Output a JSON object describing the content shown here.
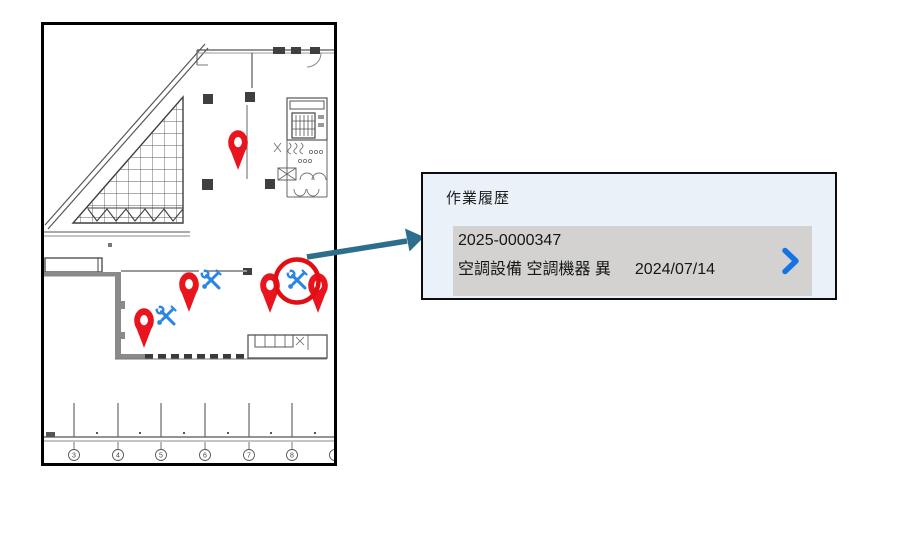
{
  "popup": {
    "title": "作業履歴",
    "item": {
      "id": "2025-0000347",
      "category": "空調設備 空調機器 異",
      "date": "2024/07/14"
    }
  },
  "floorplan": {
    "column_labels": [
      "3",
      "4",
      "5",
      "6",
      "7",
      "8"
    ]
  },
  "markers": {
    "pin_count": 5,
    "tool_icon_count": 3
  },
  "icons": {
    "pin": "map-pin",
    "tools": "wrench-and-screwdriver",
    "chevron": "chevron-right",
    "highlight": "red-circle-annotation",
    "arrow": "callout-arrow"
  },
  "colors": {
    "pin_red": "#e9141d",
    "tool_blue": "#2b85e2",
    "arrow_teal": "#2d6e8c",
    "chevron_blue": "#1474e4",
    "highlight_red": "#e10f14",
    "popup_bg": "#eaf1f9",
    "popup_border": "#0c0c0c",
    "item_bg": "#d3d2d1"
  }
}
